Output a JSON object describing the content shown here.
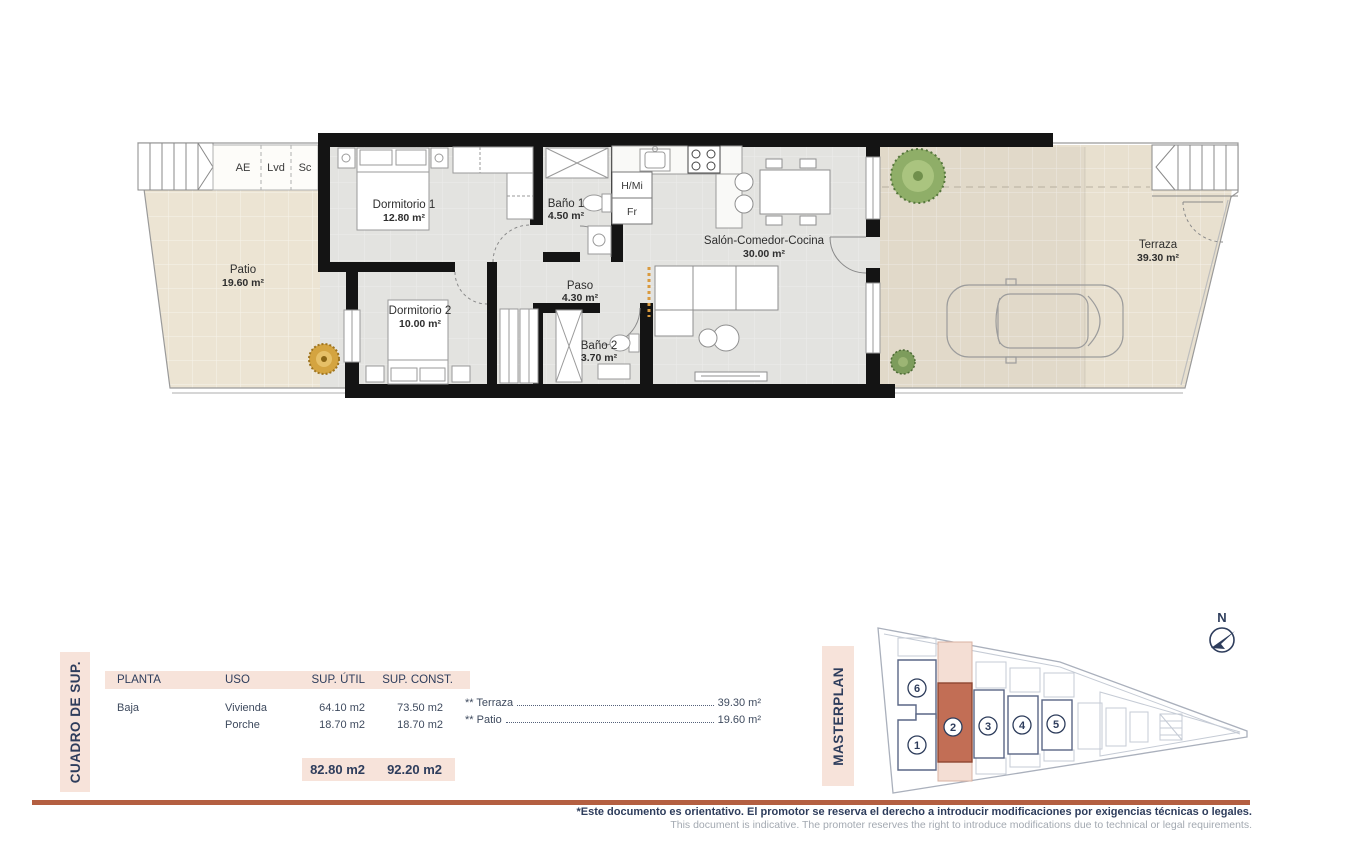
{
  "plan": {
    "rooms": [
      {
        "name": "Patio",
        "area": "19.60 m²"
      },
      {
        "name": "Dormitorio 1",
        "area": "12.80 m²"
      },
      {
        "name": "Baño 1",
        "area": "4.50 m²"
      },
      {
        "name": "Dormitorio 2",
        "area": "10.00 m²"
      },
      {
        "name": "Paso",
        "area": "4.30 m²"
      },
      {
        "name": "Baño 2",
        "area": "3.70 m²"
      },
      {
        "name": "Salón-Comedor-Cocina",
        "area": "30.00 m²"
      },
      {
        "name": "Terraza",
        "area": "39.30 m²"
      }
    ],
    "labels": {
      "ae": "AE",
      "lvd": "Lvd",
      "sc": "Sc",
      "hmi": "H/Mi",
      "fr": "Fr"
    }
  },
  "cuadro": {
    "side_label": "CUADRO DE SUP.",
    "headers": {
      "planta": "PLANTA",
      "uso": "USO",
      "sup_util": "SUP. ÚTIL",
      "sup_const": "SUP. CONST."
    },
    "rows": [
      {
        "planta": "Baja",
        "uso": "Vivienda",
        "sup_util": "64.10 m2",
        "sup_const": "73.50 m2"
      },
      {
        "planta": "",
        "uso": "Porche",
        "sup_util": "18.70 m2",
        "sup_const": "18.70 m2"
      }
    ],
    "totals": {
      "sup_util": "82.80 m2",
      "sup_const": "92.20 m2"
    },
    "extras": [
      {
        "label": "** Terraza",
        "value": "39.30 m²"
      },
      {
        "label": "** Patio",
        "value": "19.60 m²"
      }
    ]
  },
  "masterplan": {
    "side_label": "MASTERPLAN",
    "north": "N",
    "units": [
      "1",
      "2",
      "3",
      "4",
      "5",
      "6"
    ],
    "highlighted_unit": "2"
  },
  "footer": {
    "es": "*Este documento es orientativo. El promotor se reserva el derecho a introducir modificaciones por exigencias técnicas o legales.",
    "en": "This document is indicative. The promoter reserves the right to introduce modifications due to technical or legal requirements."
  },
  "colors": {
    "accent": "#b45f41",
    "pink": "#f7e3da",
    "navy": "#2e3d5c",
    "unit_highlight": "#c26e55"
  }
}
